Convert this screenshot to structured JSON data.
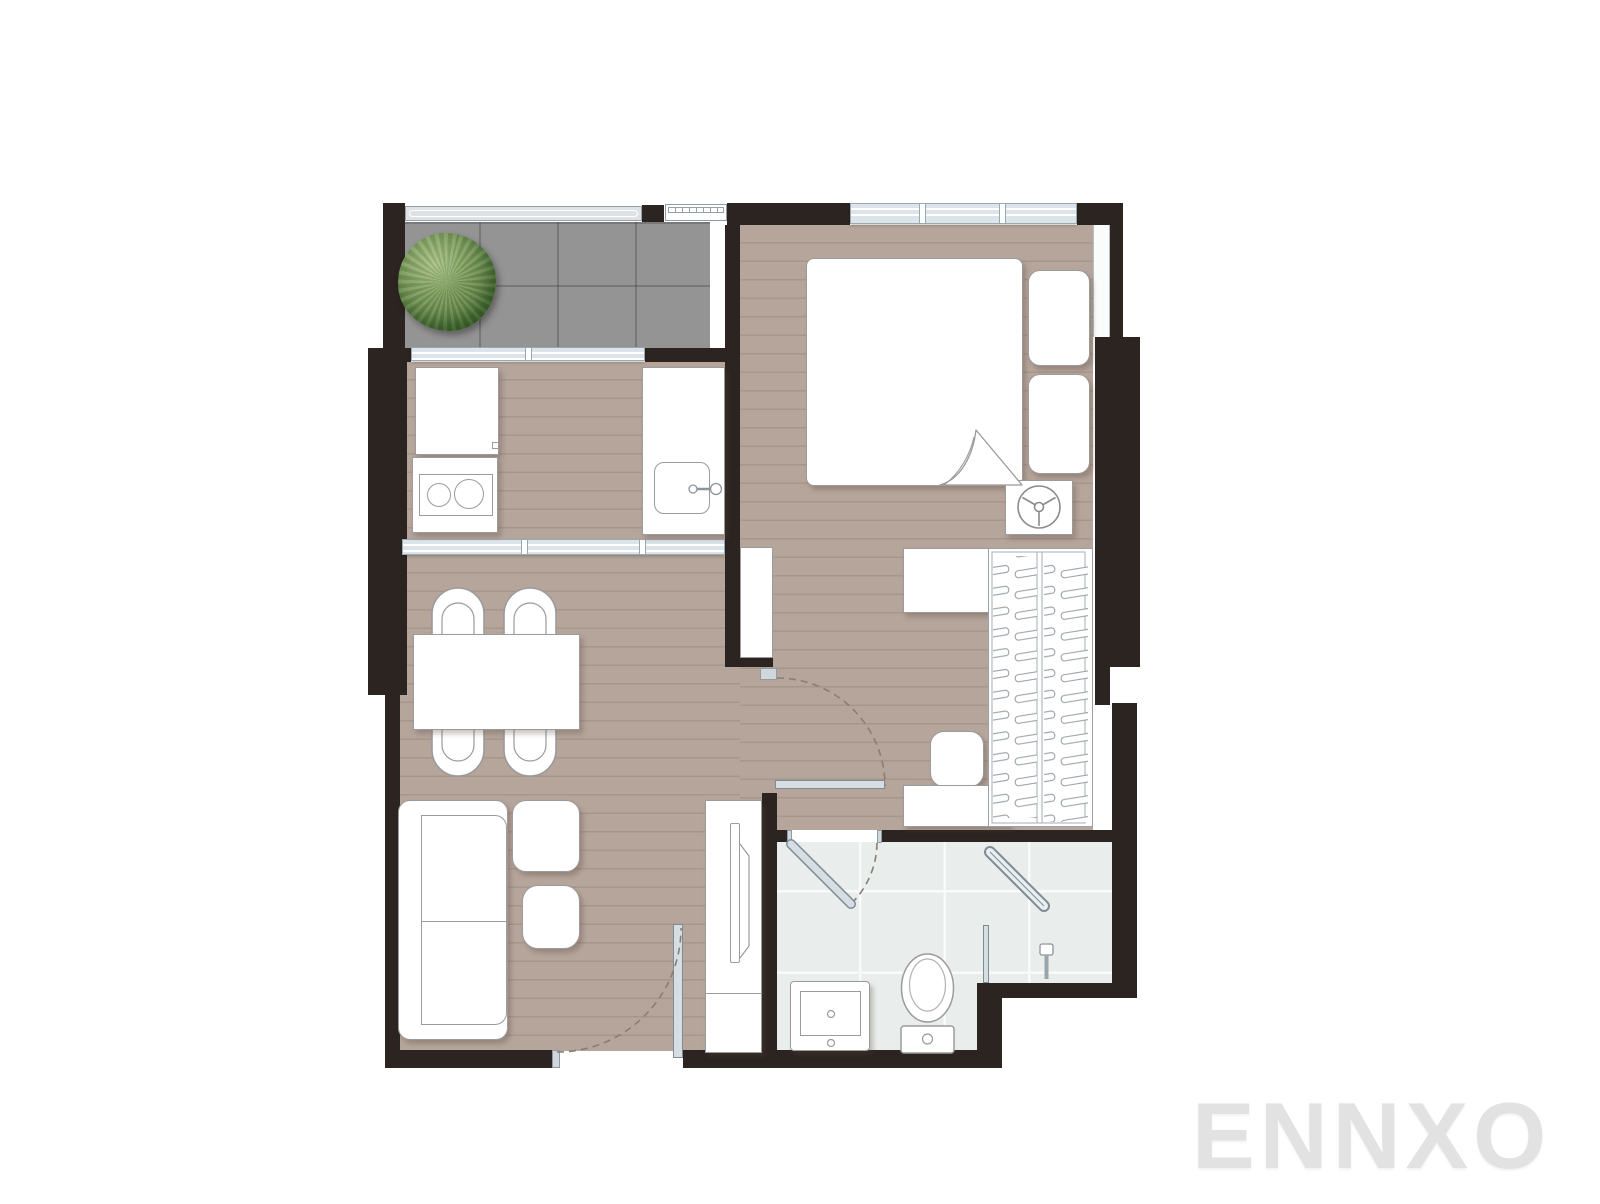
{
  "watermark": {
    "text": "ENNXO",
    "color": "#e2e2e2"
  },
  "plan": {
    "type": "apartment-floor-plan",
    "layout": "one-bedroom-unit",
    "rooms": [
      {
        "name": "balcony",
        "features": [
          "potted-tree",
          "tile-floor",
          "railing",
          "ac-compressor-unit"
        ]
      },
      {
        "name": "kitchen",
        "features": [
          "refrigerator",
          "two-burner-stove",
          "sink-counter",
          "sliding-window",
          "sliding-partition"
        ]
      },
      {
        "name": "living-dining",
        "features": [
          "dining-table",
          "four-chairs",
          "l-sofa",
          "coffee-table",
          "side-table",
          "tv-console",
          "tv",
          "entrance-door"
        ]
      },
      {
        "name": "bedroom",
        "features": [
          "double-bed",
          "nightstand",
          "nightstand",
          "fan",
          "desk",
          "stool",
          "bench",
          "wardrobe-with-hangers",
          "wall-cabinet",
          "window",
          "swing-door"
        ]
      },
      {
        "name": "bathroom",
        "features": [
          "vanity-sink",
          "toilet",
          "shower-glass-door",
          "shower-head",
          "swing-door",
          "tile-floor"
        ]
      }
    ],
    "palette": {
      "wall": "#2b2421",
      "wood_floor": "#b6a59b",
      "balcony_tile": "#949494",
      "bathroom_tile": "#e9edeb",
      "window": "#dde4e9",
      "door": "#d7dee3",
      "tree": "#5d8040",
      "furniture_outline": "#9b9b9b",
      "watermark": "#e2e2e2"
    }
  }
}
